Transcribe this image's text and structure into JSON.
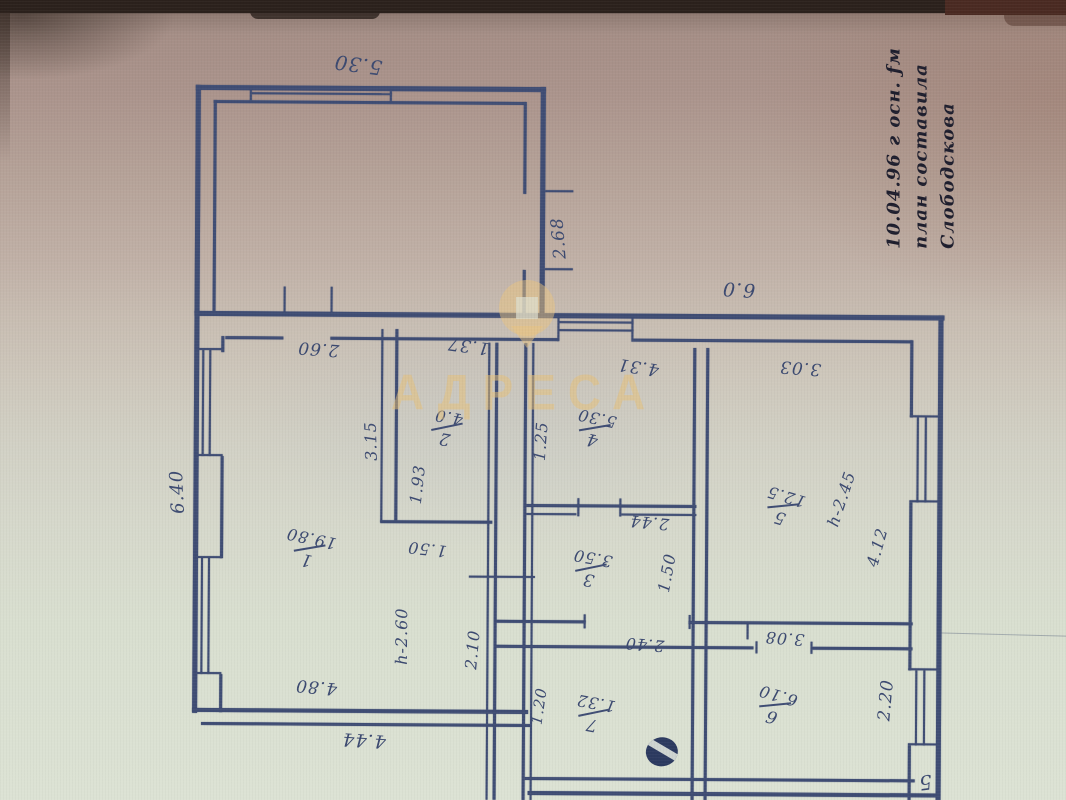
{
  "watermark": {
    "text": "АДРЕСА",
    "color": "#e6bf76"
  },
  "annotation": {
    "lines": [
      "10.04.96 г осн. ƒм",
      "план составила",
      "Слободскова"
    ]
  },
  "plan": {
    "ink_color": "#3f4d74",
    "rooms": [
      {
        "number": "1",
        "area": "19.80",
        "cx": 310,
        "cy": 550,
        "rot": 192
      },
      {
        "number": "2",
        "area": "4.0",
        "cx": 447,
        "cy": 428,
        "rot": 190
      },
      {
        "number": "4",
        "area": "5.30",
        "cx": 595,
        "cy": 428,
        "rot": 192
      },
      {
        "number": "3",
        "area": "3.50",
        "cx": 592,
        "cy": 568,
        "rot": 190
      },
      {
        "number": "5",
        "area": "12.5",
        "cx": 784,
        "cy": 505,
        "rot": 196
      },
      {
        "number": "7",
        "area": "1.32",
        "cx": 596,
        "cy": 713,
        "rot": 190
      },
      {
        "number": "6",
        "area": "6.10",
        "cx": 777,
        "cy": 704,
        "rot": 196
      }
    ],
    "dimensions": [
      {
        "text": "5.30",
        "cx": 356,
        "cy": 66,
        "rot": 187,
        "fs": 20
      },
      {
        "text": "2.68",
        "cx": 558,
        "cy": 238,
        "rot": -95,
        "fs": 17
      },
      {
        "text": "2.60",
        "cx": 318,
        "cy": 350,
        "rot": 184,
        "fs": 17
      },
      {
        "text": "1.37",
        "cx": 468,
        "cy": 346,
        "rot": 187,
        "fs": 17
      },
      {
        "text": "6.0",
        "cx": 738,
        "cy": 288,
        "rot": 183,
        "fs": 19
      },
      {
        "text": "4.31",
        "cx": 638,
        "cy": 366,
        "rot": 188,
        "fs": 17
      },
      {
        "text": "3.03",
        "cx": 800,
        "cy": 366,
        "rot": 184,
        "fs": 17
      },
      {
        "text": "3.15",
        "cx": 371,
        "cy": 442,
        "rot": -92,
        "fs": 16
      },
      {
        "text": "1.93",
        "cx": 418,
        "cy": 485,
        "rot": -84,
        "fs": 16
      },
      {
        "text": "1.25",
        "cx": 541,
        "cy": 441,
        "rot": -86,
        "fs": 16
      },
      {
        "text": "1.50",
        "cx": 428,
        "cy": 550,
        "rot": 186,
        "fs": 16
      },
      {
        "text": "2.44",
        "cx": 650,
        "cy": 522,
        "rot": 185,
        "fs": 16
      },
      {
        "text": "1.50",
        "cx": 668,
        "cy": 572,
        "rot": -80,
        "fs": 16
      },
      {
        "text": "6.40",
        "cx": 178,
        "cy": 494,
        "rot": -93,
        "fs": 18
      },
      {
        "text": "h-2.60",
        "cx": 403,
        "cy": 637,
        "rot": -90,
        "fs": 16
      },
      {
        "text": "2.10",
        "cx": 474,
        "cy": 650,
        "rot": -85,
        "fs": 16
      },
      {
        "text": "4.80",
        "cx": 318,
        "cy": 688,
        "rot": 185,
        "fs": 17
      },
      {
        "text": "4.44",
        "cx": 366,
        "cy": 741,
        "rot": 183,
        "fs": 18
      },
      {
        "text": "1.20",
        "cx": 541,
        "cy": 706,
        "rot": -82,
        "fs": 15
      },
      {
        "text": "2.40",
        "cx": 646,
        "cy": 644,
        "rot": 184,
        "fs": 16
      },
      {
        "text": "3.08",
        "cx": 786,
        "cy": 637,
        "rot": 184,
        "fs": 16
      },
      {
        "text": "2.20",
        "cx": 888,
        "cy": 698,
        "rot": -85,
        "fs": 17
      },
      {
        "text": "h-2.45",
        "cx": 842,
        "cy": 497,
        "rot": -72,
        "fs": 16
      },
      {
        "text": "4.12",
        "cx": 878,
        "cy": 545,
        "rot": -75,
        "fs": 16
      }
    ],
    "lines": [
      [
        194,
        87,
        350,
        5
      ],
      [
        212,
        102,
        312,
        3
      ],
      [
        194,
        87,
        5,
        228
      ],
      [
        212,
        102,
        3,
        213
      ],
      [
        539,
        87,
        5,
        228
      ],
      [
        522,
        102,
        3,
        92
      ],
      [
        522,
        270,
        3,
        45
      ],
      [
        250,
        94,
        140,
        2
      ],
      [
        248,
        90,
        2,
        13
      ],
      [
        388,
        90,
        2,
        13
      ],
      [
        194,
        313,
        750,
        5
      ],
      [
        225,
        338,
        58,
        3
      ],
      [
        330,
        338,
        228,
        3
      ],
      [
        633,
        338,
        279,
        3
      ],
      [
        558,
        321,
        75,
        2
      ],
      [
        558,
        329,
        75,
        2
      ],
      [
        557,
        317,
        2,
        24
      ],
      [
        631,
        317,
        2,
        24
      ],
      [
        194,
        313,
        5,
        402
      ],
      [
        221,
        338,
        3,
        16
      ],
      [
        221,
        458,
        3,
        102
      ],
      [
        221,
        676,
        3,
        38
      ],
      [
        202,
        352,
        2,
        106
      ],
      [
        209,
        352,
        2,
        106
      ],
      [
        197,
        350,
        26,
        2
      ],
      [
        197,
        456,
        26,
        2
      ],
      [
        202,
        560,
        2,
        116
      ],
      [
        209,
        560,
        2,
        116
      ],
      [
        197,
        558,
        26,
        2
      ],
      [
        197,
        674,
        26,
        2
      ],
      [
        938,
        313,
        5,
        487
      ],
      [
        910,
        338,
        3,
        77
      ],
      [
        910,
        500,
        3,
        168
      ],
      [
        910,
        743,
        3,
        57
      ],
      [
        917,
        415,
        2,
        85
      ],
      [
        925,
        415,
        2,
        85
      ],
      [
        910,
        413,
        31,
        2
      ],
      [
        910,
        498,
        31,
        2
      ],
      [
        917,
        668,
        2,
        75
      ],
      [
        925,
        668,
        2,
        75
      ],
      [
        910,
        666,
        31,
        2
      ],
      [
        910,
        741,
        31,
        2
      ],
      [
        194,
        710,
        336,
        4
      ],
      [
        203,
        724,
        330,
        3
      ],
      [
        527,
        777,
        390,
        3
      ],
      [
        530,
        791,
        412,
        4
      ],
      [
        488,
        343,
        2,
        457
      ],
      [
        495,
        343,
        3,
        457
      ],
      [
        524,
        343,
        3,
        457
      ],
      [
        532,
        343,
        2,
        457
      ],
      [
        381,
        330,
        2,
        193
      ],
      [
        395,
        330,
        3,
        193
      ],
      [
        381,
        521,
        112,
        3
      ],
      [
        527,
        504,
        170,
        3
      ],
      [
        527,
        513,
        50,
        2
      ],
      [
        622,
        513,
        75,
        2
      ],
      [
        693,
        347,
        3,
        453
      ],
      [
        706,
        347,
        3,
        453
      ],
      [
        497,
        620,
        90,
        3
      ],
      [
        690,
        620,
        224,
        3
      ],
      [
        497,
        645,
        258,
        3
      ],
      [
        814,
        645,
        100,
        3
      ],
      [
        544,
        190,
        28,
        2
      ],
      [
        544,
        268,
        28,
        2
      ],
      [
        283,
        288,
        2,
        27
      ],
      [
        330,
        288,
        2,
        27
      ],
      [
        470,
        576,
        66,
        2
      ],
      [
        578,
        498,
        2,
        18
      ],
      [
        620,
        498,
        2,
        18
      ],
      [
        585,
        614,
        2,
        14
      ],
      [
        690,
        614,
        2,
        14
      ],
      [
        757,
        640,
        2,
        12
      ],
      [
        812,
        640,
        2,
        12
      ],
      [
        748,
        622,
        2,
        16
      ]
    ],
    "stray_mark": {
      "text": "5",
      "cx": 928,
      "cy": 780,
      "rot": 172
    }
  }
}
